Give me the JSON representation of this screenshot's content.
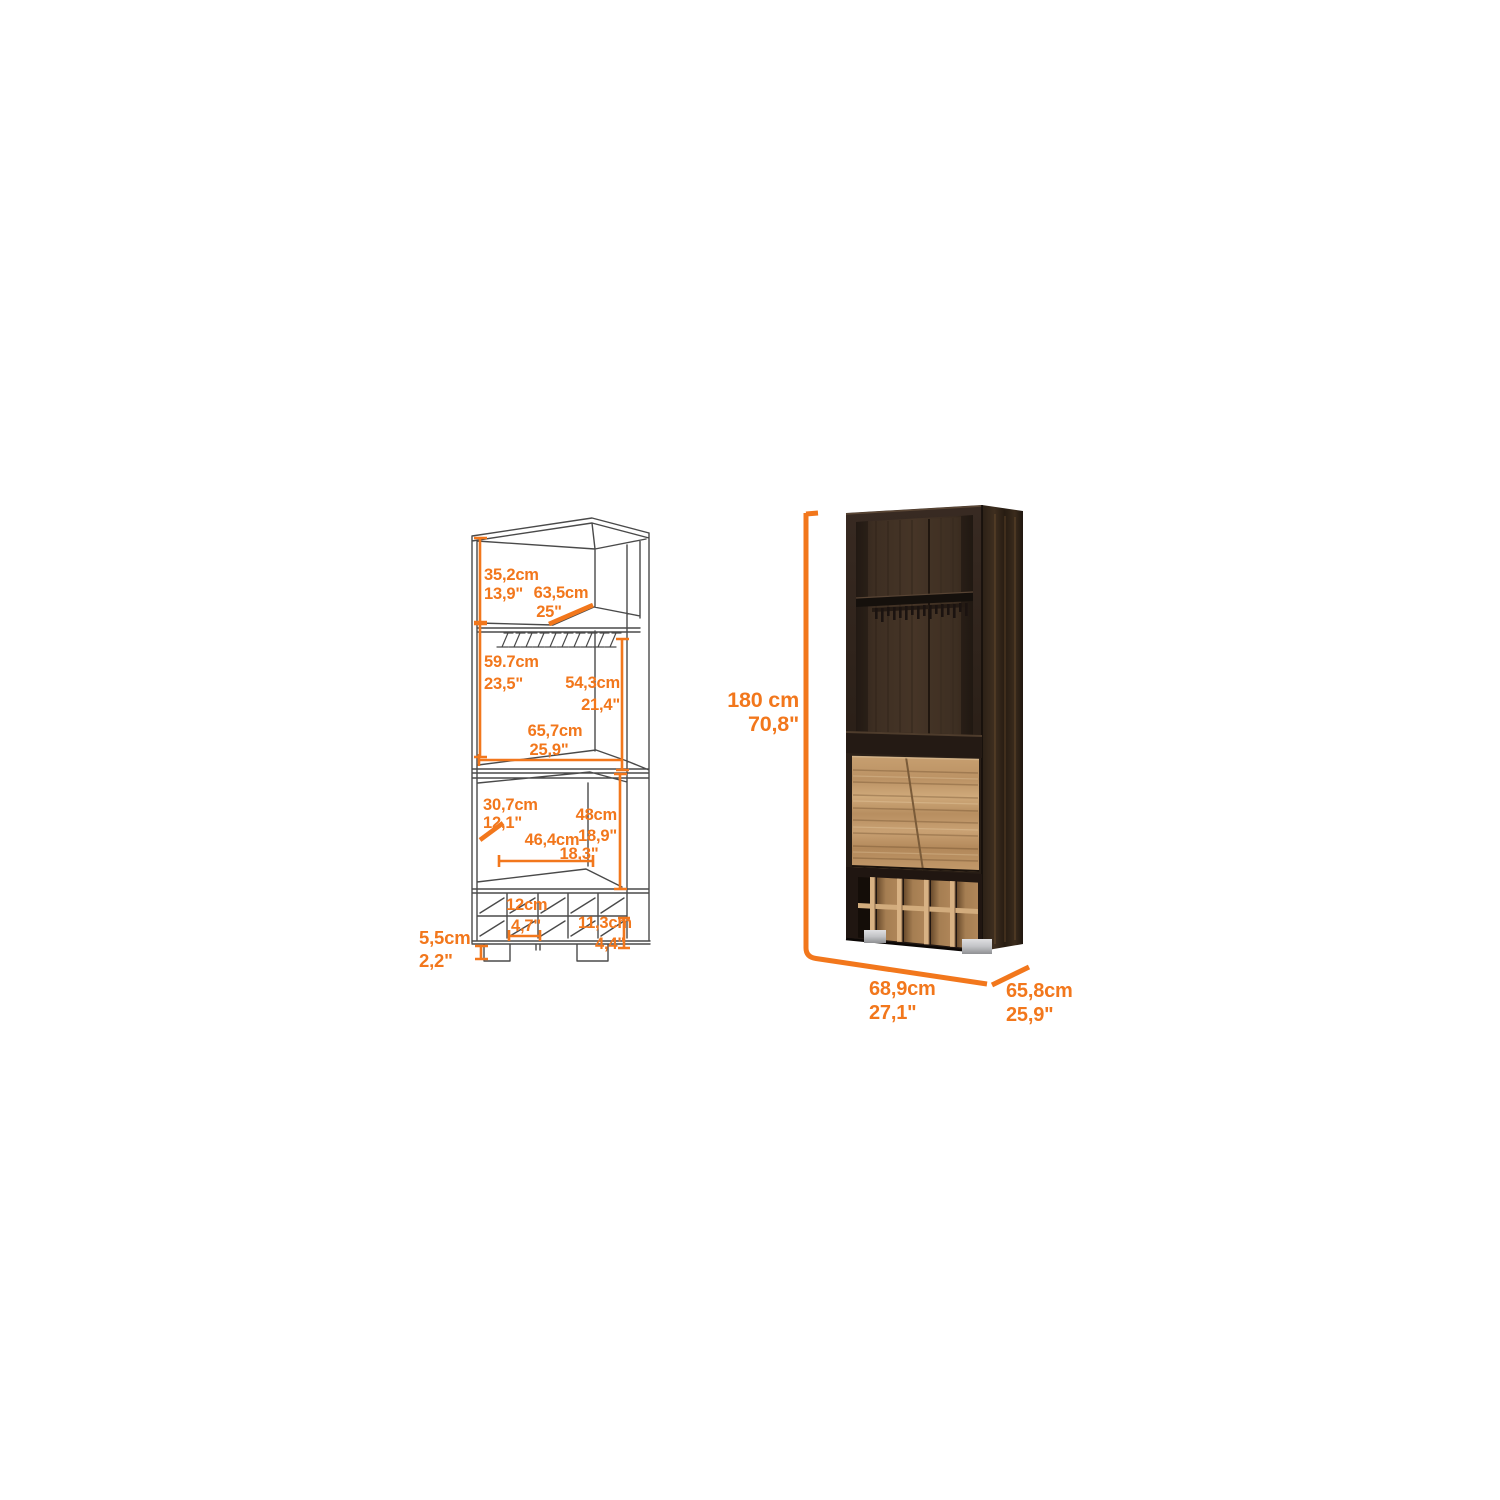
{
  "accent_color": "#F2771C",
  "background_color": "#ffffff",
  "left_diagram": {
    "description": "wireframe corner bar cabinet with dimension callouts",
    "labels": {
      "top_height": {
        "cm": "35,2cm",
        "in": "13,9\""
      },
      "top_width": {
        "cm": "63,5cm",
        "in": "25\""
      },
      "mid_height": {
        "cm": "59.7cm",
        "in": "23,5\""
      },
      "inner_height": {
        "cm": "54,3cm",
        "in": "21,4\""
      },
      "mid_width": {
        "cm": "65,7cm",
        "in": "25,9\""
      },
      "lower_depth": {
        "cm": "30,7cm",
        "in": "12,1\""
      },
      "lower_height": {
        "cm": "48cm",
        "in": "18,9\""
      },
      "lower_width": {
        "cm": "46,4cm",
        "in": "18,3\""
      },
      "cubby_width": {
        "cm": "12cm",
        "in": "4,7\""
      },
      "cubby_height": {
        "cm": "11,3cm",
        "in": "4,4\""
      },
      "foot_height": {
        "cm": "5,5cm",
        "in": "2,2\""
      }
    }
  },
  "right_figure": {
    "description": "rendered corner bar cabinet, dark walnut with oak doors and 10 bottle cubbies",
    "labels": {
      "height": {
        "cm": "180 cm",
        "in": "70,8\""
      },
      "width": {
        "cm": "68,9cm",
        "in": "27,1\""
      },
      "depth": {
        "cm": "65,8cm",
        "in": "25,9\""
      }
    }
  }
}
